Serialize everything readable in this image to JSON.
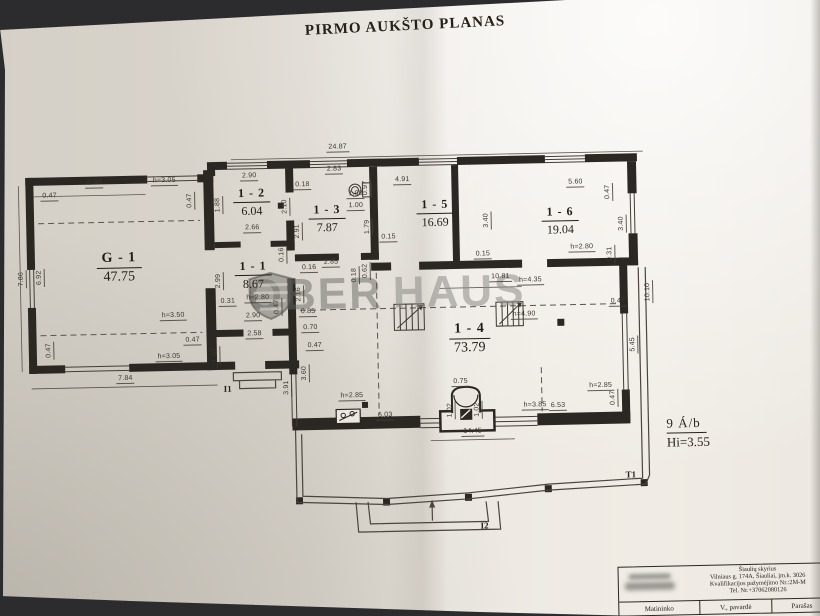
{
  "title": "PIRMO AUKŠTO PLANAS",
  "watermark": {
    "left": "OBER",
    "right": "HAUS",
    "logo": "shield-icon"
  },
  "note": {
    "line1": "9 Á/b",
    "line2": "Hi=3.55"
  },
  "plan": {
    "rooms": [
      {
        "id": "G - 1",
        "area": "47.75",
        "x": 120,
        "y": 262,
        "lg": 1
      },
      {
        "id": "1 - 2",
        "area": "6.04",
        "x": 254,
        "y": 199
      },
      {
        "id": "1 - 3",
        "area": "7.87",
        "x": 329,
        "y": 217
      },
      {
        "id": "1 - 1",
        "area": "8.67",
        "x": 254,
        "y": 272
      },
      {
        "id": "1 - 5",
        "area": "16.69",
        "x": 437,
        "y": 214
      },
      {
        "id": "1 - 6",
        "area": "19.04",
        "x": 562,
        "y": 224
      },
      {
        "id": "1 - 4",
        "area": "73.79",
        "x": 469,
        "y": 340,
        "lg": 1
      }
    ],
    "dimensions": [
      {
        "t": "24.87",
        "x": 341,
        "y": 151
      },
      {
        "t": "6.90",
        "x": 97,
        "y": 182
      },
      {
        "t": "h=3.05",
        "x": 167,
        "y": 181
      },
      {
        "t": "0.47",
        "x": 52,
        "y": 194
      },
      {
        "t": "0.47",
        "x": 193,
        "y": 196,
        "v": 1
      },
      {
        "t": "1.88",
        "x": 221,
        "y": 201,
        "v": 1
      },
      {
        "t": "7.86",
        "x": 23,
        "y": 271,
        "v": 1
      },
      {
        "t": "6.92",
        "x": 41,
        "y": 270,
        "v": 1
      },
      {
        "t": "2.99",
        "x": 220,
        "y": 277,
        "v": 1
      },
      {
        "t": "0.31",
        "x": 228,
        "y": 303
      },
      {
        "t": "h=3.50",
        "x": 173,
        "y": 316
      },
      {
        "t": "0.47",
        "x": 49,
        "y": 343,
        "v": 1
      },
      {
        "t": "h=3.05",
        "x": 168,
        "y": 357
      },
      {
        "t": "0.47",
        "x": 192,
        "y": 341
      },
      {
        "t": "7.84",
        "x": 124,
        "y": 378
      },
      {
        "t": "1.67",
        "x": 215,
        "y": 351,
        "v": 1
      },
      {
        "t": "2.90",
        "x": 252,
        "y": 178
      },
      {
        "t": "2.66",
        "x": 254,
        "y": 230
      },
      {
        "t": "0.18",
        "x": 305,
        "y": 188
      },
      {
        "t": "2.10",
        "x": 288,
        "y": 204,
        "v": 1
      },
      {
        "t": "2.91",
        "x": 300,
        "y": 229,
        "v": 1
      },
      {
        "t": "0.16",
        "x": 284,
        "y": 252,
        "v": 1
      },
      {
        "t": "2.85",
        "x": 332,
        "y": 266
      },
      {
        "t": "0.16",
        "x": 310,
        "y": 271
      },
      {
        "t": "0.18",
        "x": 356,
        "y": 274,
        "v": 1
      },
      {
        "t": "0.62",
        "x": 367,
        "y": 270,
        "v": 1
      },
      {
        "t": "h=2.80",
        "x": 258,
        "y": 300
      },
      {
        "t": "2.90",
        "x": 253,
        "y": 318
      },
      {
        "t": "0.47",
        "x": 278,
        "y": 304,
        "v": 1
      },
      {
        "t": "0.85",
        "x": 308,
        "y": 315
      },
      {
        "t": "0.70",
        "x": 310,
        "y": 331
      },
      {
        "t": "2.58",
        "x": 254,
        "y": 336
      },
      {
        "t": "0.47",
        "x": 314,
        "y": 349
      },
      {
        "t": "2.16",
        "x": 300,
        "y": 292,
        "v": 1
      },
      {
        "t": "2.83",
        "x": 337,
        "y": 173
      },
      {
        "t": "0.97",
        "x": 369,
        "y": 187,
        "v": 1
      },
      {
        "t": "1.00",
        "x": 358,
        "y": 198
      },
      {
        "t": "1.00",
        "x": 358,
        "y": 210
      },
      {
        "t": "1.79",
        "x": 370,
        "y": 226,
        "v": 1
      },
      {
        "t": "0.15",
        "x": 390,
        "y": 242
      },
      {
        "t": "4.91",
        "x": 405,
        "y": 185
      },
      {
        "t": "3.40",
        "x": 489,
        "y": 222,
        "v": 1
      },
      {
        "t": "0.15",
        "x": 484,
        "y": 261
      },
      {
        "t": "5.60",
        "x": 578,
        "y": 191
      },
      {
        "t": "0.47",
        "x": 611,
        "y": 196,
        "v": 1
      },
      {
        "t": "3.40",
        "x": 624,
        "y": 228,
        "v": 1
      },
      {
        "t": "h=2.80",
        "x": 583,
        "y": 256
      },
      {
        "t": "0.31",
        "x": 612,
        "y": 258,
        "v": 1
      },
      {
        "t": "10.81",
        "x": 501,
        "y": 284
      },
      {
        "t": "h=4.35",
        "x": 531,
        "y": 288
      },
      {
        "t": "h=4.90",
        "x": 524,
        "y": 322
      },
      {
        "t": "0.47",
        "x": 618,
        "y": 311
      },
      {
        "t": "3.60",
        "x": 304,
        "y": 371,
        "v": 1
      },
      {
        "t": "3.91",
        "x": 286,
        "y": 385,
        "v": 1
      },
      {
        "t": "h=2.85",
        "x": 350,
        "y": 400
      },
      {
        "t": "6.03",
        "x": 383,
        "y": 420
      },
      {
        "t": "h=3.85",
        "x": 533,
        "y": 413
      },
      {
        "t": "6.53",
        "x": 556,
        "y": 414
      },
      {
        "t": "h=2.85",
        "x": 599,
        "y": 395
      },
      {
        "t": "0.47",
        "x": 612,
        "y": 402,
        "v": 1
      },
      {
        "t": "0.75",
        "x": 459,
        "y": 388
      },
      {
        "t": "1.02",
        "x": 449,
        "y": 411,
        "v": 1
      },
      {
        "t": "1.02",
        "x": 476,
        "y": 411,
        "v": 1
      },
      {
        "t": "14.45",
        "x": 470,
        "y": 438
      },
      {
        "t": "10.10",
        "x": 649,
        "y": 297,
        "v": 1
      },
      {
        "t": "5.45",
        "x": 633,
        "y": 349,
        "v": 1
      }
    ],
    "marks": [
      {
        "t": "I1",
        "x": 222,
        "y": 380
      },
      {
        "t": "I2",
        "x": 476,
        "y": 522
      },
      {
        "t": "T1",
        "x": 622,
        "y": 474
      }
    ]
  },
  "titleblock": {
    "line1": "Šiaulių skyrius",
    "line2": "Vilniaus g. 174A, Šiauliai, įm.k. 3026",
    "line3": "Kvalifikacijos pažymėjimo Nr.:2M-M",
    "line4": "Tel. Nr.+37062080126",
    "cells": [
      "Matininko",
      "V., pavardė",
      "Parašas"
    ]
  }
}
